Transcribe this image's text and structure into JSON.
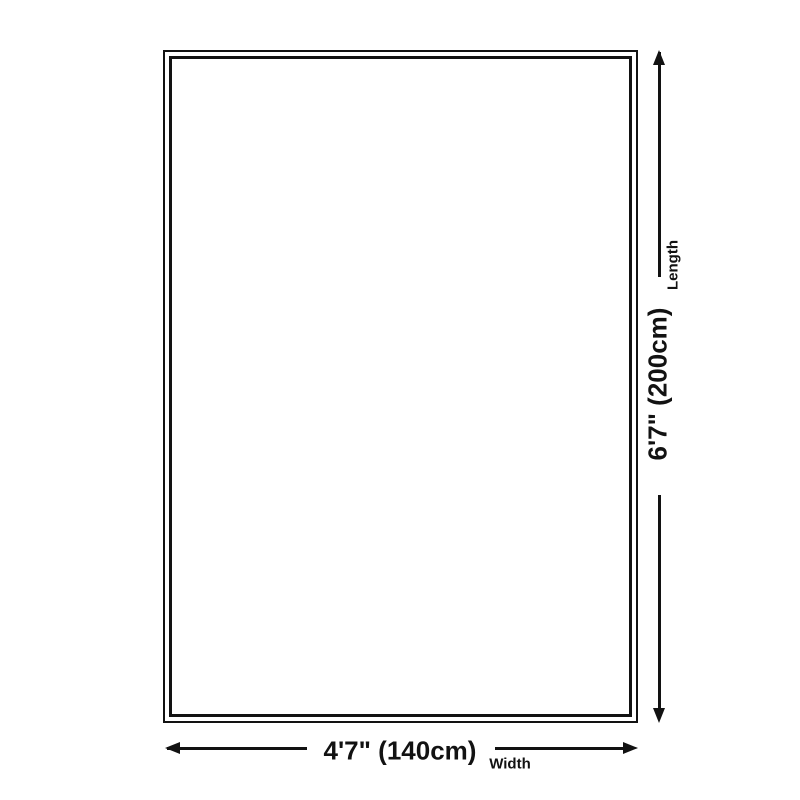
{
  "diagram": {
    "type": "product-dimension-diagram",
    "shape": "rectangle",
    "colors": {
      "background": "#ffffff",
      "line": "#121212",
      "text": "#121212"
    },
    "length_dimension": {
      "value": "6'7\" (200cm)",
      "label": "Length"
    },
    "width_dimension": {
      "value": "4'7\" (140cm)",
      "label": "Width"
    }
  }
}
